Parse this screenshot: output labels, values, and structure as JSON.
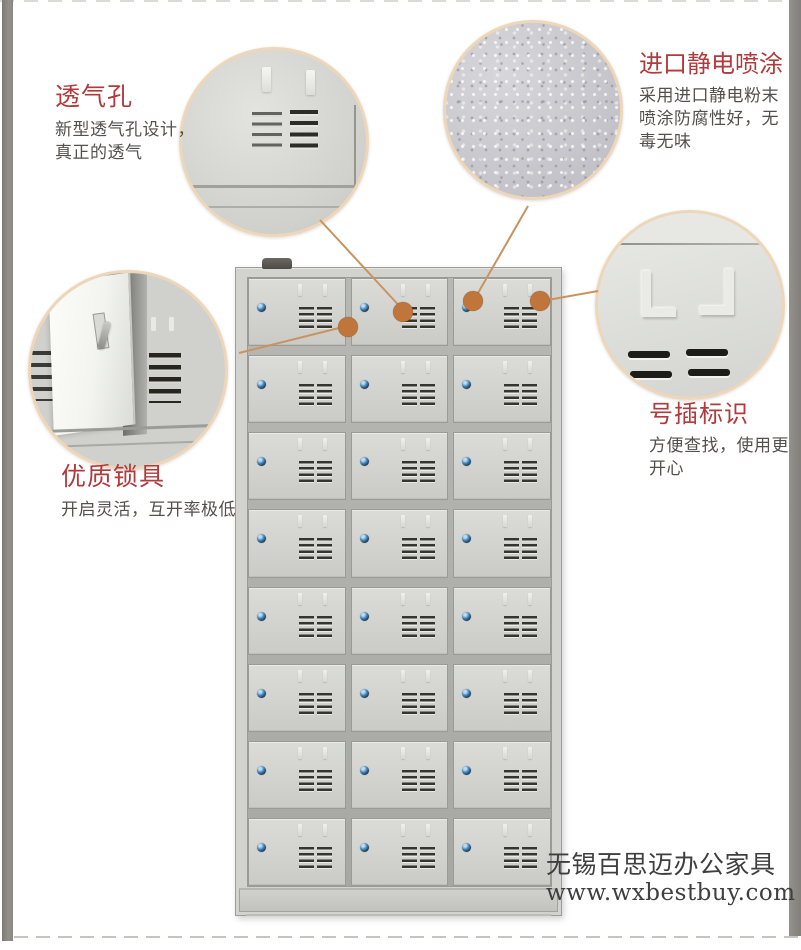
{
  "callouts": {
    "vent": {
      "title": "透气孔",
      "lines": [
        "新型透气孔设计，",
        "真正的透气"
      ]
    },
    "coating": {
      "title": "进口静电喷涂",
      "lines": [
        "采用进口静电粉末",
        "喷涂防腐性好，无",
        "毒无味"
      ]
    },
    "lock": {
      "title": "优质锁具",
      "lines": [
        "开启灵活，互开率极低"
      ]
    },
    "label": {
      "title": "号插标识",
      "lines": [
        "方便查找，使用更",
        "开心"
      ]
    }
  },
  "watermark": {
    "company": "无锡百思迈办公家具",
    "website": "www.wxbestbuy.com"
  },
  "cabinet": {
    "rows": 8,
    "columns": 3,
    "door_count": 24
  },
  "colors": {
    "accent_red": "#b03a3c",
    "connector_orange": "#c0763a",
    "connector_line": "#c9935f",
    "lock_blue": "#3d7fb5",
    "bubble_border": "#eed6b8",
    "cabinet_gray": "#d2d3cf",
    "side_strip_gray": "#8a8681"
  }
}
